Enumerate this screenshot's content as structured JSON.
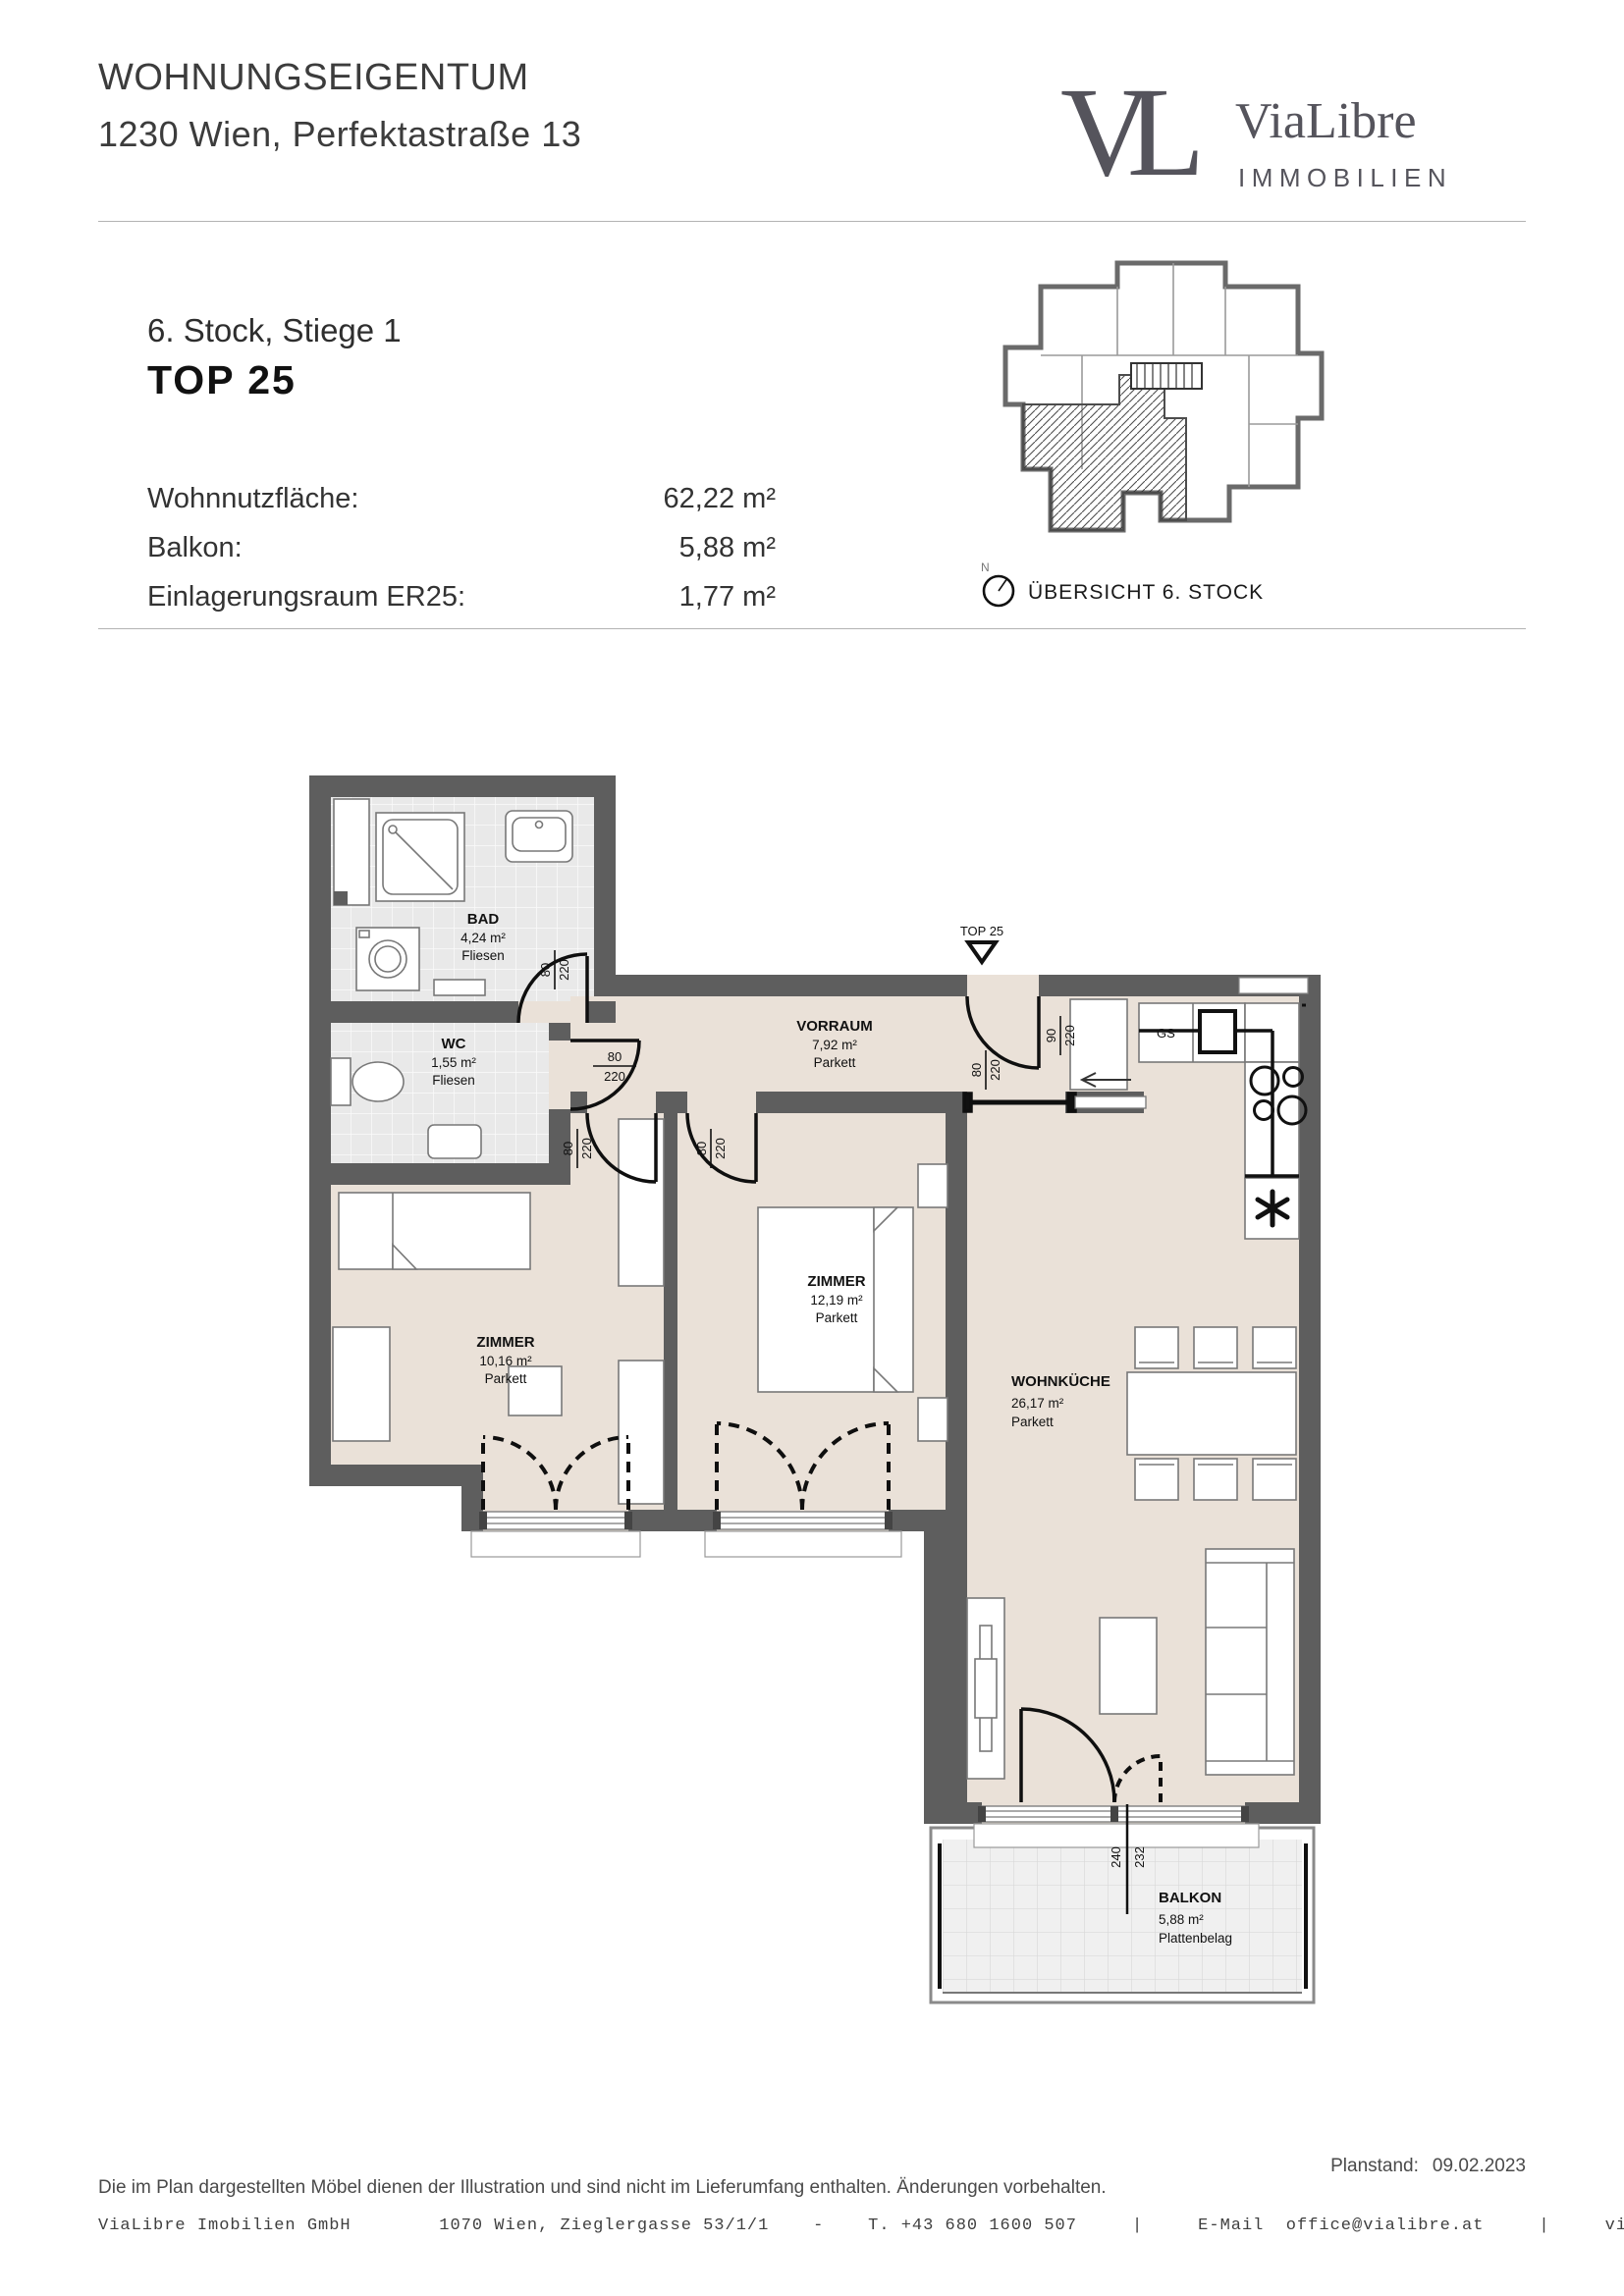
{
  "header": {
    "title": "WOHNUNGSEIGENTUM",
    "address": "1230 Wien, Perfektastraße 13"
  },
  "logo": {
    "monogram": "VL",
    "name": "ViaLibre",
    "subtitle": "IMMOBILIEN"
  },
  "unit": {
    "floor_line": "6. Stock, Stiege 1",
    "top_label": "TOP 25"
  },
  "areas": {
    "rows": [
      {
        "label": "Wohnnutzfläche:",
        "value": "62,22 m²"
      },
      {
        "label": "Balkon:",
        "value": "5,88 m²"
      },
      {
        "label": "Einlagerungsraum ER25:",
        "value": "1,77 m²"
      }
    ]
  },
  "overview": {
    "compass_n": "N",
    "caption": "ÜBERSICHT 6. STOCK"
  },
  "plan": {
    "entrance": {
      "top_label": "TOP 25"
    },
    "dims": {
      "w80": "80",
      "h220": "220",
      "w90": "90",
      "w240": "240",
      "h232": "232"
    },
    "kitchen": {
      "gs": "GS"
    },
    "rooms": {
      "bad": {
        "name": "BAD",
        "area": "4,24 m²",
        "floor": "Fliesen"
      },
      "wc": {
        "name": "WC",
        "area": "1,55 m²",
        "floor": "Fliesen"
      },
      "vorraum": {
        "name": "VORRAUM",
        "area": "7,92 m²",
        "floor": "Parkett"
      },
      "zimmer1": {
        "name": "ZIMMER",
        "area": "10,16 m²",
        "floor": "Parkett"
      },
      "zimmer2": {
        "name": "ZIMMER",
        "area": "12,19 m²",
        "floor": "Parkett"
      },
      "wohnkueche": {
        "name": "WOHNKÜCHE",
        "area": "26,17 m²",
        "floor": "Parkett"
      },
      "balkon": {
        "name": "BALKON",
        "area": "5,88 m²",
        "floor": "Plattenbelag"
      }
    }
  },
  "footer": {
    "plan_date_label": "Planstand:",
    "plan_date": "09.02.2023",
    "disclaimer": "Die im Plan dargestellten Möbel dienen der Illustration und sind nicht im Lieferumfang enthalten. Änderungen vorbehalten.",
    "contact": "ViaLibre Imobilien GmbH        1070 Wien, Zieglergasse 53/1/1    -    T. +43 680 1600 507     |     E-Mail  office@vialibre.at     |     vialibre.at   |   UID ATU77818435"
  }
}
